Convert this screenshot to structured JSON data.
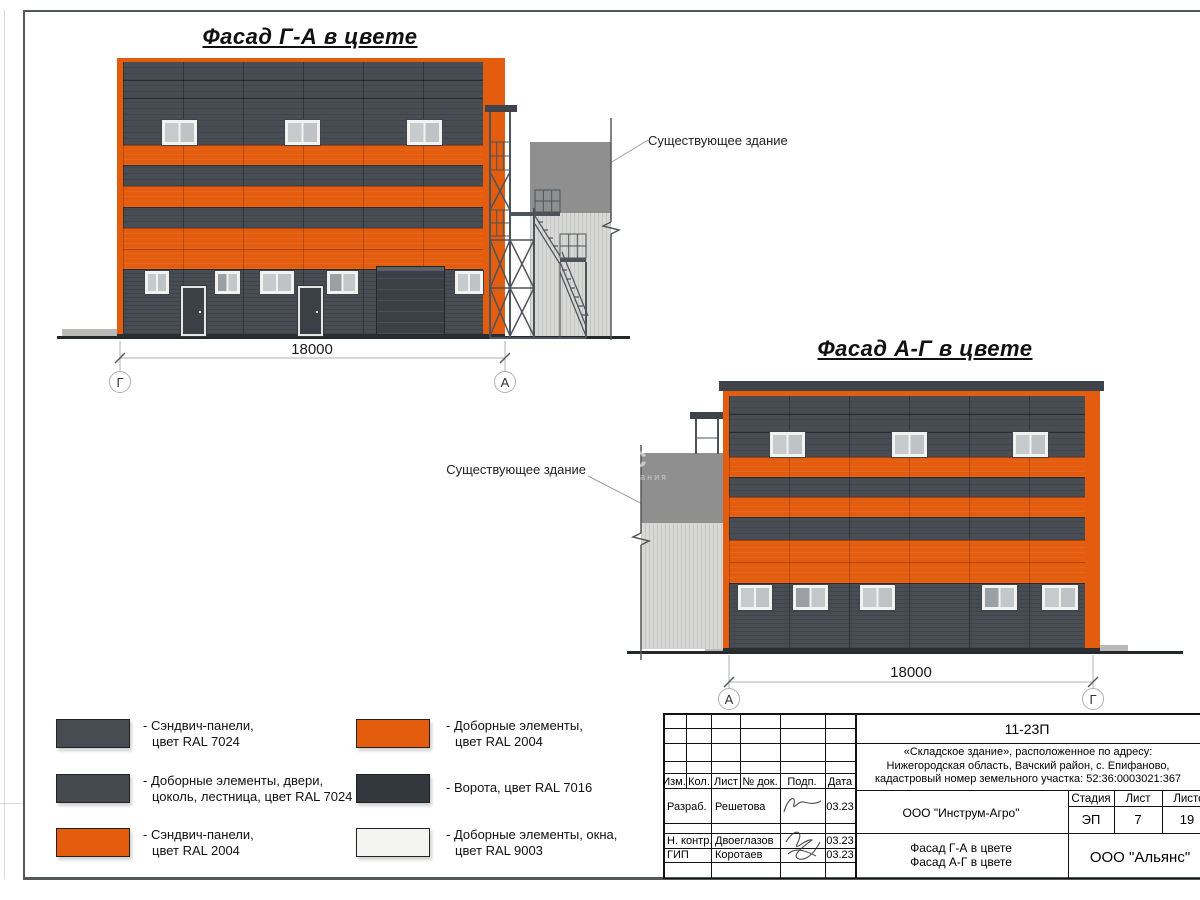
{
  "colors": {
    "orange": "#e45c0e",
    "panel_dark": "#484d53",
    "panel_darker": "#41464c",
    "gate": "#3a4046",
    "window_frame": "#f2f2f0",
    "glass": "#c7cbce",
    "existing_dark": "#8f8f8f",
    "existing_light": "#d8d8d6",
    "steel": "#4e535a",
    "ground": "#26292c",
    "col": "60px"
  },
  "facade1": {
    "title": "Фасад Г-А в цвете",
    "dim": "18000",
    "axis_left": "Г",
    "axis_right": "А",
    "note": "Существующее здание"
  },
  "facade2": {
    "title": "Фасад А-Г в цвете",
    "dim": "18000",
    "axis_left": "А",
    "axis_right": "Г",
    "note": "Существующее здание"
  },
  "watermark": {
    "big": "нс",
    "small": "компания"
  },
  "legend": {
    "items": [
      {
        "line1": "- Сэндвич-панели,",
        "line2": "цвет RAL 7024"
      },
      {
        "line1": "- Доборные элементы, двери,",
        "line2": "цоколь, лестница, цвет RAL 7024"
      },
      {
        "line1": "- Сэндвич-панели,",
        "line2": "цвет RAL 2004"
      },
      {
        "line1": "- Доборные элементы,",
        "line2": "цвет RAL 2004"
      },
      {
        "line1": "- Ворота, цвет RAL 7016",
        "line2": ""
      },
      {
        "line1": "- Доборные элементы, окна,",
        "line2": "цвет RAL 9003"
      }
    ]
  },
  "titleblock": {
    "doc_number": "11-23П",
    "project_line1": "«Складское здание», расположенное по адресу:",
    "project_line2": "Нижегородская область, Вачский район, с. Епифаново,",
    "project_line3": "кадастровый номер земельного участка: 52:36:0003021:367",
    "col_izm": "Изм.",
    "col_kol": "Кол.",
    "col_list": "Лист",
    "col_doc": "№ док.",
    "col_podp": "Подп.",
    "col_data": "Дата",
    "row1_role": "Разраб.",
    "row1_name": "Решетова",
    "row1_date": "03.23",
    "row2_role": "Н. контр.",
    "row2_name": "Двоеглазов",
    "row2_date": "03.23",
    "row3_role": "ГИП",
    "row3_name": "Коротаев",
    "row3_date": "03.23",
    "company": "ООО \"Инструм-Агро\"",
    "drawing_title_line1": "Фасад Г-А в цвете",
    "drawing_title_line2": "Фасад А-Г в цвете",
    "stage_label": "Стадия",
    "list_label": "Лист",
    "listov_label": "Листов",
    "stage": "ЭП",
    "list_num": "7",
    "listov_num": "19",
    "org": "ООО \"Альянс\""
  }
}
